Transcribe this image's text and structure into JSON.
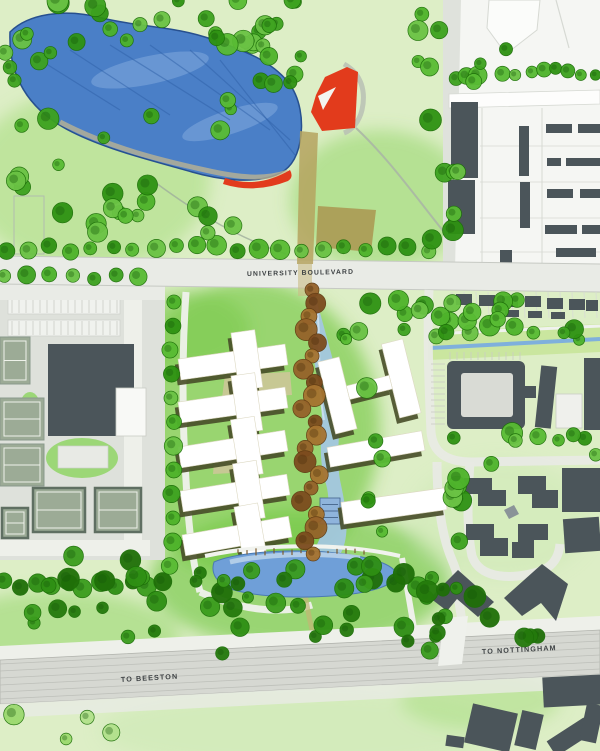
{
  "page": {
    "title": "Campus Masterplan Site Plan"
  },
  "labels": {
    "university_boulevard": "UNIVERSITY BOULEVARD",
    "to_beeston": "TO BEESTON",
    "to_nottingham": "TO NOTTINGHAM"
  },
  "label_placement": {
    "university_boulevard": {
      "x": 247,
      "y": 276,
      "rot": -1.2,
      "size": 6.8
    },
    "to_beeston": {
      "x": 121,
      "y": 682,
      "rot": -3.4,
      "size": 7.2
    },
    "to_nottingham": {
      "x": 482,
      "y": 654,
      "rot": -3.0,
      "size": 7.2
    }
  },
  "colors": {
    "grass_base": "#ddeec6",
    "grass_bright1": "#74c844",
    "grass_bright2": "#6cc43e",
    "grass_mid": "#a5dc7c",
    "grass_soft": "#8ed360",
    "grass_pale": "#cdeab4",
    "tree_greens": [
      "#4db32a",
      "#3da21f",
      "#58bb33",
      "#2e9212",
      "#6ac244"
    ],
    "tree_darks": [
      "#2e8f13",
      "#247a0c",
      "#3a9c1d",
      "#1f6f08"
    ],
    "tree_pales": [
      "#9ad86e",
      "#b2e18c"
    ],
    "tree_stroke": "#1c6e08",
    "browns": [
      "#95622a",
      "#7c4b1e",
      "#a5722f"
    ],
    "brown_stroke": "#5f3a12",
    "water_lake": "#4a7fc7",
    "water_edge": "#27508f",
    "water_streak": "#2d5fa8",
    "water_light": "#8fb3e2",
    "water_pond": "#6f9fd8",
    "water_stream": "#a4c6e6",
    "water_canal": "#7fb0dc",
    "road_white": "#eef0ea",
    "road_gray": "#e9ebe6",
    "road_edge": "#c6c9c3",
    "rail_band": "#d6d8d2",
    "rail_hatch": "#b9bbb5",
    "urban_white": "#f5f6f3",
    "plot_line": "#d6d9d3",
    "building_dark": "#4b555a",
    "building_white": "#ffffff",
    "shadow_olive": "#474d28",
    "khaki": "#cfc69a",
    "red_accent": "#e23b1c",
    "path_tan": "#b5a35f",
    "field_tan": "#ab9a54",
    "shore_tan": "#c9b98c",
    "court_fill": "#9cab96",
    "court_line": "#eef2ea",
    "court_frame": "#5f6f62",
    "sports_base": "#dee1db",
    "lawn": "#86d355"
  },
  "map": {
    "width": 600,
    "height": 751,
    "grass_blobs": [
      {
        "cx": 250,
        "cy": 430,
        "rx": 130,
        "ry": 150,
        "fill": "grass_bright1",
        "op": 0.65
      },
      {
        "cx": 300,
        "cy": 580,
        "rx": 150,
        "ry": 70,
        "fill": "grass_bright2",
        "op": 0.6
      },
      {
        "cx": 90,
        "cy": 180,
        "rx": 120,
        "ry": 90,
        "fill": "grass_mid",
        "op": 0.55
      },
      {
        "cx": 380,
        "cy": 200,
        "rx": 90,
        "ry": 70,
        "fill": "grass_soft",
        "op": 0.5
      },
      {
        "cx": 500,
        "cy": 520,
        "rx": 90,
        "ry": 60,
        "fill": "grass_pale",
        "op": 0.5
      },
      {
        "cx": 60,
        "cy": 640,
        "rx": 120,
        "ry": 50,
        "fill": "grass_soft",
        "op": 0.5
      },
      {
        "cx": 300,
        "cy": 730,
        "rx": 200,
        "ry": 40,
        "fill": "grass_pale",
        "op": 0.6
      },
      {
        "cx": 480,
        "cy": 700,
        "rx": 80,
        "ry": 30,
        "fill": "grass_mid",
        "op": 0.5
      },
      {
        "cx": 190,
        "cy": 330,
        "rx": 60,
        "ry": 40,
        "fill": "grass_bright1",
        "op": 0.5
      }
    ],
    "lake": {
      "path": "M10,32 C28,14 64,8 102,18 C138,27 176,26 214,40 C248,52 272,62 288,82 C300,97 304,120 300,142 C297,158 290,170 276,175 C252,184 220,180 192,172 C150,160 108,150 72,132 C36,114 8,84 10,32 Z",
      "streaks": [
        "M40,60 L120,110",
        "M70,50 L170,115",
        "M110,45 L230,120",
        "M150,45 L270,130",
        "M190,50 L290,140",
        "M220,60 L295,155"
      ],
      "highlights": [
        {
          "cx": 150,
          "cy": 70,
          "rx": 60,
          "ry": 14,
          "rot": -12
        },
        {
          "cx": 230,
          "cy": 122,
          "rx": 50,
          "ry": 12,
          "rot": -18
        }
      ],
      "shore": "M60,122 C110,148 160,160 205,170 C240,178 265,180 288,172",
      "red_crescent": "M225,178 Q258,189 290,170 Q294,177 288,181 Q255,194 223,184 Z"
    },
    "red_plaza": {
      "fan": "M316,95 L325,77 L347,67 L358,72 L355,128 L322,131 L311,112 Z",
      "notch": "M318,96 L336,87 L323,110 Z",
      "arc": "M344,64 C362,74 366,92 362,110 C359,122 352,130 344,133"
    },
    "paths": {
      "tan_main": "M300,131 L318,133 L313,264 L297,264 Z",
      "tan_cross": "M298,264 L312,264 L312,296 L298,296 Z",
      "field": "M318,206 L376,210 L371,252 L316,247 Z",
      "winding": "M356,128 C390,160 418,200 444,232 C452,244 454,254 452,264",
      "park1": "M148,177 C185,205 230,235 286,254",
      "park_rect": {
        "x": 14,
        "y": 196,
        "w": 30,
        "h": 58
      },
      "dev_tan": "M300,560 C304,590 308,615 314,638",
      "pond_rail": "M402,558 C408,592 412,616 416,640"
    },
    "boulevard": {
      "band": "M0,256 L600,264 L600,292 L0,284 Z",
      "left_merge": {
        "x": 0,
        "y": 284,
        "w": 165,
        "h": 16
      },
      "top_edge": "M0,256 L600,264",
      "bottom_edge": "M0,284 L600,292"
    },
    "canal": {
      "verge": "M428,332 L600,324 L600,352 L428,360 Z",
      "blue": "M430,348 L600,339",
      "white": "M430,334 L600,326"
    },
    "urban": {
      "zone": "M447,58 L461,0 L600,0 L600,270 L449,270 Z",
      "road": "M443,0 L461,0 L455,270 L443,270 Z",
      "outline1": "M489,0 L540,0 L537,30 L506,54 L487,28 Z",
      "outline2": "M556,0 L569,48",
      "street": "M449,94 L600,90 L600,104 L449,108 Z",
      "grid_v": [
        482,
        542
      ],
      "grid_h": [
        146,
        182,
        218,
        252
      ],
      "dark": [
        [
          451,
          102,
          27,
          76,
          0
        ],
        [
          448,
          180,
          27,
          54,
          0
        ],
        [
          519,
          126,
          10,
          50,
          0
        ],
        [
          520,
          182,
          10,
          46,
          0
        ],
        [
          546,
          124,
          26,
          9,
          0
        ],
        [
          578,
          124,
          22,
          9,
          0
        ],
        [
          547,
          158,
          14,
          8,
          0
        ],
        [
          566,
          158,
          34,
          8,
          0
        ],
        [
          547,
          189,
          26,
          9,
          0
        ],
        [
          580,
          189,
          20,
          9,
          0
        ],
        [
          545,
          225,
          32,
          9,
          0
        ],
        [
          582,
          225,
          18,
          9,
          0
        ],
        [
          556,
          248,
          40,
          9,
          0
        ],
        [
          500,
          250,
          12,
          14,
          0
        ]
      ]
    },
    "terraces": {
      "bars": [
        [
          456,
          294,
          16,
          11
        ],
        [
          479,
          295,
          16,
          11
        ],
        [
          502,
          296,
          16,
          11
        ],
        [
          525,
          296,
          16,
          11
        ],
        [
          547,
          298,
          16,
          11
        ],
        [
          569,
          299,
          16,
          11
        ],
        [
          586,
          300,
          12,
          11
        ],
        [
          505,
          310,
          14,
          7
        ],
        [
          528,
          311,
          14,
          7
        ],
        [
          551,
          312,
          14,
          7
        ]
      ],
      "plot_x1": 452,
      "plot_x2": 600,
      "plot_step": 12,
      "plot_y1": 292,
      "plot_y2": 318
    },
    "sports": {
      "base": {
        "x": 0,
        "y": 290,
        "w": 165,
        "h": 270
      },
      "roads": [
        {
          "x": 124,
          "y": 290,
          "w": 18,
          "h": 252
        },
        {
          "x": 0,
          "y": 540,
          "w": 150,
          "h": 16
        }
      ],
      "parking": [
        {
          "x": 8,
          "y": 298,
          "w": 112,
          "h": 16
        },
        {
          "x": 8,
          "y": 320,
          "w": 112,
          "h": 16
        }
      ],
      "building": "M48,344 L134,344 L134,414 L116,414 L116,436 L48,436 Z",
      "wing": {
        "x": 116,
        "y": 388,
        "w": 30,
        "h": 48
      },
      "annex": {
        "x": 58,
        "y": 446,
        "w": 50,
        "h": 22
      },
      "lawns": [
        {
          "cx": 82,
          "cy": 458,
          "rx": 36,
          "ry": 20
        },
        {
          "cx": 30,
          "cy": 414,
          "rx": 12,
          "ry": 22
        }
      ],
      "courts": [
        {
          "x": 0,
          "y": 337,
          "w": 30,
          "h": 47,
          "frame": false
        },
        {
          "x": 0,
          "y": 398,
          "w": 44,
          "h": 42,
          "frame": false
        },
        {
          "x": 0,
          "y": 444,
          "w": 44,
          "h": 42,
          "frame": false
        },
        {
          "x": 2,
          "y": 508,
          "w": 26,
          "h": 30,
          "frame": true
        },
        {
          "x": 33,
          "y": 488,
          "w": 52,
          "h": 44,
          "frame": true
        },
        {
          "x": 95,
          "y": 488,
          "w": 46,
          "h": 44,
          "frame": true
        }
      ]
    },
    "dev": {
      "roads": [
        "M186,292 C182,350 182,420 186,480 C188,520 192,560 200,592",
        "M200,592 C240,610 280,615 312,605"
      ],
      "plus_buildings": [
        {
          "cx": 233,
          "cy": 362,
          "rot": -8
        },
        {
          "cx": 233,
          "cy": 405,
          "rot": -8
        },
        {
          "cx": 233,
          "cy": 449,
          "rot": -9
        },
        {
          "cx": 235,
          "cy": 493,
          "rot": -9
        },
        {
          "cx": 237,
          "cy": 536,
          "rot": -10
        }
      ],
      "plus_geom": {
        "bar_w": 108,
        "bar_h": 21,
        "cross_w": 24,
        "cross_h": 58,
        "cross_dx": 14
      },
      "khaki_patches": [
        "M225,375 L290,372 L292,395 L222,398 Z",
        "M215,450 L250,447 L252,472 L213,474 Z"
      ],
      "h_building": {
        "cx": 375,
        "cy": 385,
        "rot": -14
      },
      "slabs": [
        {
          "cx": 376,
          "cy": 449,
          "rot": -10,
          "w": 96,
          "h": 20
        },
        {
          "cx": 394,
          "cy": 506,
          "rot": -8,
          "w": 104,
          "h": 22
        }
      ],
      "stream": "M305,290 C318,318 308,348 318,378 C328,412 314,448 326,484 C334,512 320,540 310,558 L338,558 C352,538 346,508 340,480 C334,446 346,408 336,372 C328,340 320,314 314,290 Z",
      "stream_streak": "M316,300 C322,340 316,380 324,420",
      "water_feature": {
        "x": 320,
        "y": 498,
        "w": 20,
        "h": 26
      },
      "brown_chain": {
        "n": 21,
        "y0": 290,
        "dy": 13.2,
        "x0": 311,
        "amp": 8
      }
    },
    "campus_right": {
      "c_outer": {
        "x": 447,
        "y": 361,
        "w": 78,
        "h": 68
      },
      "c_inner": {
        "x": 461,
        "y": 373,
        "w": 52,
        "h": 44
      },
      "c_stub": {
        "x": 524,
        "y": 386,
        "w": 12,
        "h": 12
      },
      "right_dark": [
        [
          584,
          358,
          16,
          72,
          0
        ],
        [
          538,
          366,
          16,
          62,
          6
        ]
      ],
      "right_light": {
        "x": 556,
        "y": 394,
        "w": 26,
        "h": 34
      },
      "loop_roads": [
        "M429,290 C427,335 429,390 431,432 C433,454 448,462 472,462 L600,460",
        "M437,462 C437,500 441,534 452,560 C458,574 460,584 458,596",
        "M470,462 C468,492 466,526 472,556 C478,574 498,578 518,576 C544,573 558,566 560,544",
        "M458,596 C461,614 463,628 465,642"
      ],
      "courtyard_blocks": [
        "M464,478 L492,478 L492,490 L506,490 L506,506 L478,506 L478,494 L464,494 Z",
        "M518,476 L546,476 L546,490 L558,490 L558,508 L532,508 L532,494 L518,494 Z",
        "M466,524 L494,524 L494,538 L508,538 L508,556 L480,556 L480,540 L466,540 Z",
        "M518,524 L548,524 L548,540 L534,540 L534,558 L512,558 L512,542 L518,542 Z"
      ],
      "courtyard_blob": "M504,510 l10,-5 l5,9 l-10,5 Z",
      "slabs": [
        [
          562,
          468,
          38,
          44,
          0
        ],
        [
          564,
          518,
          36,
          34,
          -4
        ]
      ]
    },
    "pond": {
      "body": "M214,562 C240,551 300,548 345,554 C372,558 392,564 396,573 C398,582 382,590 352,594 C312,599 262,598 234,590 C218,585 210,574 214,562 Z",
      "highlight": "M230,562 C265,554 320,552 360,558",
      "top_path": "M205,556 C260,544 340,542 400,556",
      "trunk_x1": 238,
      "trunk_x2": 368,
      "trunk_step": 9,
      "trunk_y": 548
    },
    "railway": {
      "verge_top": "M0,646 L600,616 L600,630 L0,660 Z",
      "band": "M0,660 L600,630 L600,674 L0,704 Z",
      "verge_bot": "M0,704 L600,674 L600,688 L0,718 Z",
      "hatch_n": 6,
      "hatch_y0": 664,
      "hatch_dy": 7,
      "hatch_drop": 30,
      "bridge": "M444,618 L468,616 L462,664 L438,666 Z"
    },
    "l_buildings": [
      "M430,598 L458,570 L494,602 L478,617 L457,599 L447,611 Z",
      "M504,598 L542,564 L568,584 L556,621 L541,603 L522,616 Z"
    ],
    "bottom_right_dark": [
      [
        543,
        676,
        58,
        30,
        -3
      ],
      [
        468,
        708,
        46,
        40,
        13
      ],
      [
        518,
        712,
        22,
        36,
        13
      ],
      [
        548,
        728,
        44,
        18,
        -33
      ],
      [
        583,
        704,
        17,
        38,
        12
      ],
      [
        446,
        736,
        18,
        11,
        8
      ]
    ],
    "tree_rows": [
      {
        "x1": 8,
        "x2": 434,
        "y": 249,
        "step": 21,
        "r": 8,
        "jy": 4,
        "pal": "greens"
      },
      {
        "x1": 6,
        "x2": 158,
        "y": 277,
        "step": 22,
        "r": 8,
        "jy": 3,
        "pal": "greens"
      },
      {
        "x1": 504,
        "x2": 598,
        "y": 72,
        "step": 13,
        "r": 6.5,
        "jy": 4,
        "pal": "greens"
      },
      {
        "x1": 4,
        "x2": 178,
        "y": 585,
        "step": 16,
        "r": 8,
        "jy": 6,
        "pal": "darks"
      }
    ],
    "tree_col": {
      "x": 172,
      "y1": 302,
      "y2": 585,
      "step": 24,
      "r": 8,
      "jx": 4
    },
    "tree_clusters": [
      {
        "x": 55,
        "y": 0,
        "w": 290,
        "h": 46,
        "n": 26,
        "pal": "greens"
      },
      {
        "x": 0,
        "y": 18,
        "w": 52,
        "h": 112,
        "n": 9,
        "pal": "greens"
      },
      {
        "x": 4,
        "y": 98,
        "w": 258,
        "h": 140,
        "n": 24,
        "pal": "greens"
      },
      {
        "x": 258,
        "y": 46,
        "w": 48,
        "h": 38,
        "n": 6,
        "pal": "greens"
      },
      {
        "x": 448,
        "y": 48,
        "w": 60,
        "h": 48,
        "n": 7,
        "pal": "greens"
      },
      {
        "x": 416,
        "y": 0,
        "w": 28,
        "h": 92,
        "n": 5,
        "pal": "greens"
      },
      {
        "x": 424,
        "y": 118,
        "w": 46,
        "h": 140,
        "n": 7,
        "pal": "greens"
      },
      {
        "x": 436,
        "y": 300,
        "w": 162,
        "h": 40,
        "n": 18,
        "pal": "greens"
      },
      {
        "x": 188,
        "y": 560,
        "w": 250,
        "h": 95,
        "n": 32,
        "pal": "darks"
      },
      {
        "x": 28,
        "y": 556,
        "w": 150,
        "h": 82,
        "n": 15,
        "pal": "darks"
      },
      {
        "x": 452,
        "y": 428,
        "w": 145,
        "h": 36,
        "n": 9,
        "pal": "greens"
      },
      {
        "x": 450,
        "y": 468,
        "w": 16,
        "h": 95,
        "n": 7,
        "pal": "greens"
      },
      {
        "x": 416,
        "y": 578,
        "w": 60,
        "h": 48,
        "n": 7,
        "pal": "darks"
      },
      {
        "x": 366,
        "y": 348,
        "w": 26,
        "h": 200,
        "n": 7,
        "pal": "greens"
      },
      {
        "x": 6,
        "y": 700,
        "w": 110,
        "h": 46,
        "n": 4,
        "pal": "pales"
      },
      {
        "x": 220,
        "y": 638,
        "w": 18,
        "h": 16,
        "n": 1,
        "pal": "darks"
      },
      {
        "x": 332,
        "y": 300,
        "w": 96,
        "h": 40,
        "n": 9,
        "pal": "greens"
      },
      {
        "x": 488,
        "y": 612,
        "w": 50,
        "h": 26,
        "n": 4,
        "pal": "darks"
      }
    ]
  }
}
